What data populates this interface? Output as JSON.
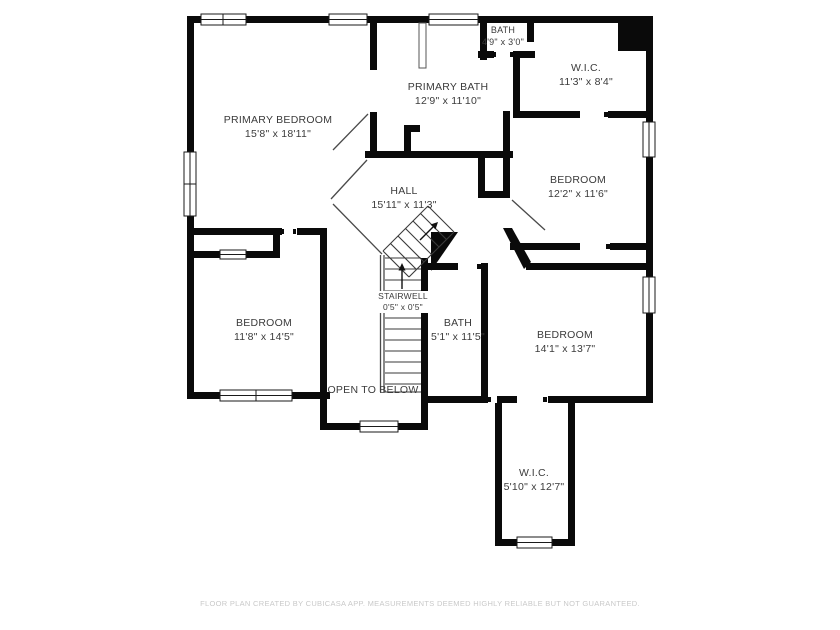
{
  "page": {
    "background": "#ffffff",
    "wall_color": "#0a0a0a",
    "label_color": "#3b3b3b",
    "footer_color": "#c9c9c9"
  },
  "rooms": {
    "primary_bedroom": {
      "name": "PRIMARY BEDROOM",
      "dimensions": "15'8\" x 18'11\""
    },
    "primary_bath": {
      "name": "PRIMARY BATH",
      "dimensions": "12'9\" x 11'10\""
    },
    "bath_top": {
      "name": "BATH",
      "dimensions": "4'9\" x 3'0\""
    },
    "wic_top": {
      "name": "W.I.C.",
      "dimensions": "11'3\" x 8'4\""
    },
    "bedroom_right": {
      "name": "BEDROOM",
      "dimensions": "12'2\" x 11'6\""
    },
    "hall": {
      "name": "HALL",
      "dimensions": "15'11\" x 11'3\""
    },
    "stairwell": {
      "name": "STAIRWELL",
      "dimensions": "0'5\" x 0'5\""
    },
    "bedroom_left": {
      "name": "BEDROOM",
      "dimensions": "11'8\" x 14'5\""
    },
    "bath_center": {
      "name": "BATH",
      "dimensions": "5'1\" x 11'5\""
    },
    "bedroom_bottom": {
      "name": "BEDROOM",
      "dimensions": "14'1\" x 13'7\""
    },
    "open_to_below": {
      "name": "OPEN TO BELOW"
    },
    "wic_bottom": {
      "name": "W.I.C.",
      "dimensions": "5'10\" x 12'7\""
    }
  },
  "footer": {
    "disclaimer": "FLOOR PLAN CREATED BY CUBICASA APP. MEASUREMENTS DEEMED HIGHLY RELIABLE BUT NOT GUARANTEED."
  }
}
